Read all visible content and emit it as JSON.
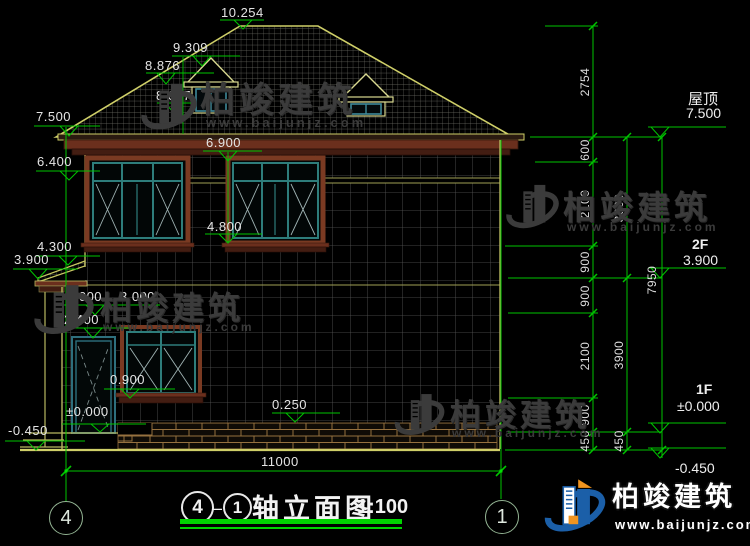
{
  "watermark": {
    "name": "柏竣建筑",
    "url": "www.baijunjz.com"
  },
  "logo": {
    "name": "柏竣建筑",
    "url": "www.baijunjz.com"
  },
  "title": {
    "axis_start": "4",
    "axis_end": "1",
    "text": "轴立面图",
    "scale": "1:100"
  },
  "axis_bubbles": {
    "left": "4",
    "right": "1"
  },
  "elevation_labels": {
    "e10254": "10.254",
    "e9309": "9.309",
    "e8876": "8.876",
    "e8077": "8.077",
    "e7500": "7.500",
    "e6900": "6.900",
    "e6400": "6.400",
    "e4800": "4.800",
    "e4300": "4.300",
    "e3900": "3.900",
    "e3000a": "3.000",
    "e3000b": "3.000",
    "e2400": "2.400",
    "e0900": "0.900",
    "e0000": "±0.000",
    "em0450": "-0.450",
    "e0250": "0.250"
  },
  "dimensions": {
    "total_width": "11000",
    "chain_a": [
      "2754",
      "600",
      "2100",
      "900",
      "900",
      "2100",
      "900",
      "450"
    ],
    "chain_b": [
      "3600",
      "3900",
      "450"
    ],
    "chain_c": [
      "7950"
    ]
  },
  "floor_labels": {
    "roof": "屋顶",
    "roof_level": "7.500",
    "f2": "2F",
    "f2_level": "3.900",
    "f1": "1F",
    "f1_level": "±0.000",
    "ground_level": "-0.450"
  },
  "colors": {
    "dim_green": "#00c400",
    "outline_yellow": "#c9c963",
    "frame_brown": "#6b2f1d",
    "sash_teal": "#2e7d7b",
    "watermark_gray": "#3b3b3b",
    "logo_blue": "#1b5fa8",
    "logo_orange": "#f0941f"
  }
}
